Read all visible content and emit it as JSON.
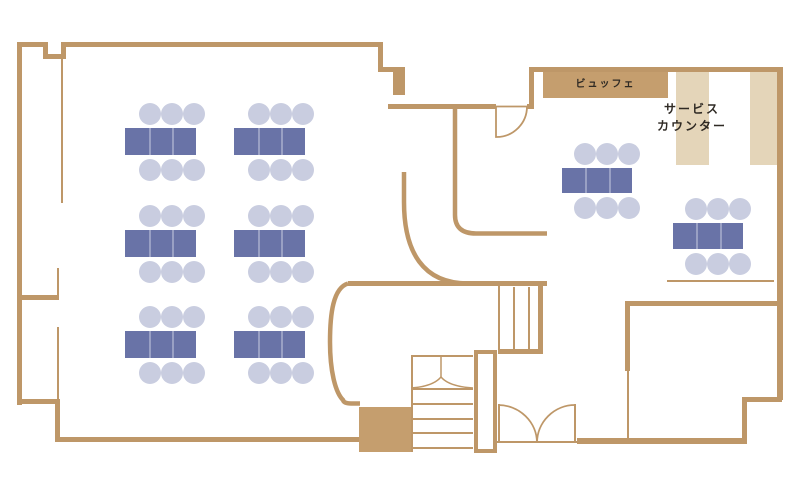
{
  "labels": {
    "buffet": "ビュッフェ",
    "service_counter_line1": "サービス",
    "service_counter_line2": "カウンター"
  },
  "colors": {
    "background": "#FFFFFF",
    "wall": "#BE9768",
    "counter_fill": "#C59E6E",
    "light_counter_fill": "#E4D5B9",
    "table_fill": "#6973A7",
    "table_divider": "#99A0C4",
    "chair_fill": "#C9CDE0",
    "label_text": "#2F2A24"
  },
  "furniture": {
    "banquet_room": {
      "table_columns_x": [
        125,
        234
      ],
      "table_rows_y": [
        128,
        230,
        331
      ],
      "table_width": 71,
      "table_height": 27,
      "chairs_per_side": 3,
      "chair_offsets_x": [
        14,
        36,
        58
      ],
      "chair_radius": 11,
      "chair_gap_above": 14,
      "chair_gap_below": 15
    },
    "dining_room": {
      "tables": [
        {
          "x": 562,
          "y": 168,
          "width": 70,
          "height": 25
        },
        {
          "x": 673,
          "y": 223,
          "width": 70,
          "height": 26
        }
      ],
      "chairs_per_side": 3,
      "chair_offsets_x": [
        12,
        34,
        56
      ],
      "chair_radius": 11,
      "chair_gap_above": 14,
      "chair_gap_below": 15
    }
  }
}
